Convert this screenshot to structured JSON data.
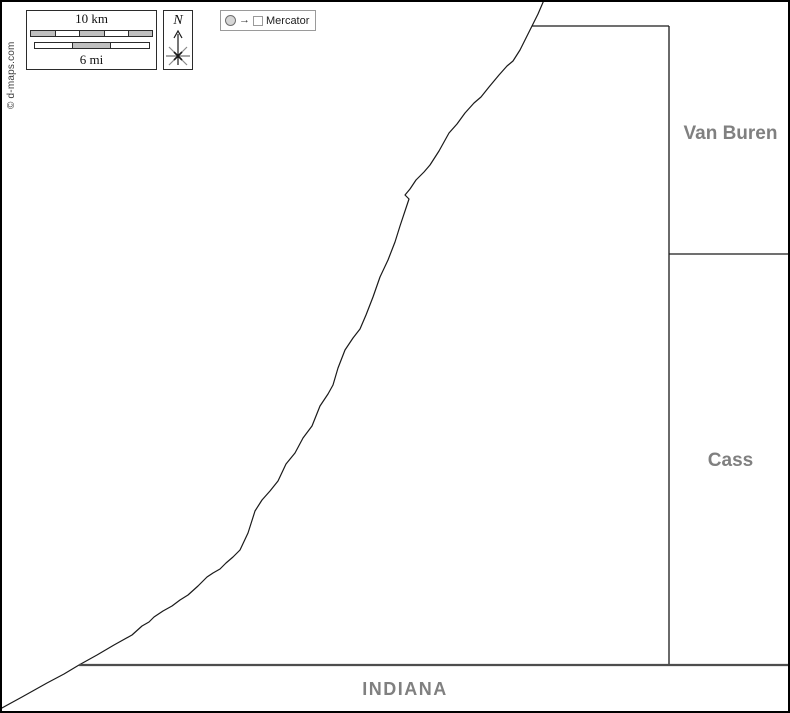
{
  "legend": {
    "scale": {
      "km_label": "10 km",
      "mi_label": "6 mi",
      "km_segments": 5,
      "mi_segments": 3
    },
    "north": {
      "label": "N"
    },
    "projection": {
      "label": "Mercator"
    }
  },
  "credit": {
    "text": "© d-maps.com"
  },
  "labels": {
    "van_buren": "Van Buren",
    "cass": "Cass",
    "indiana": "INDIANA"
  },
  "colors": {
    "background": "#ffffff",
    "frame_border": "#000000",
    "county_border": "#1a1a1a",
    "state_line": "#4d4d4d",
    "region_label_gray": "#808080",
    "scale_fill_gray": "#c0c0c0"
  }
}
